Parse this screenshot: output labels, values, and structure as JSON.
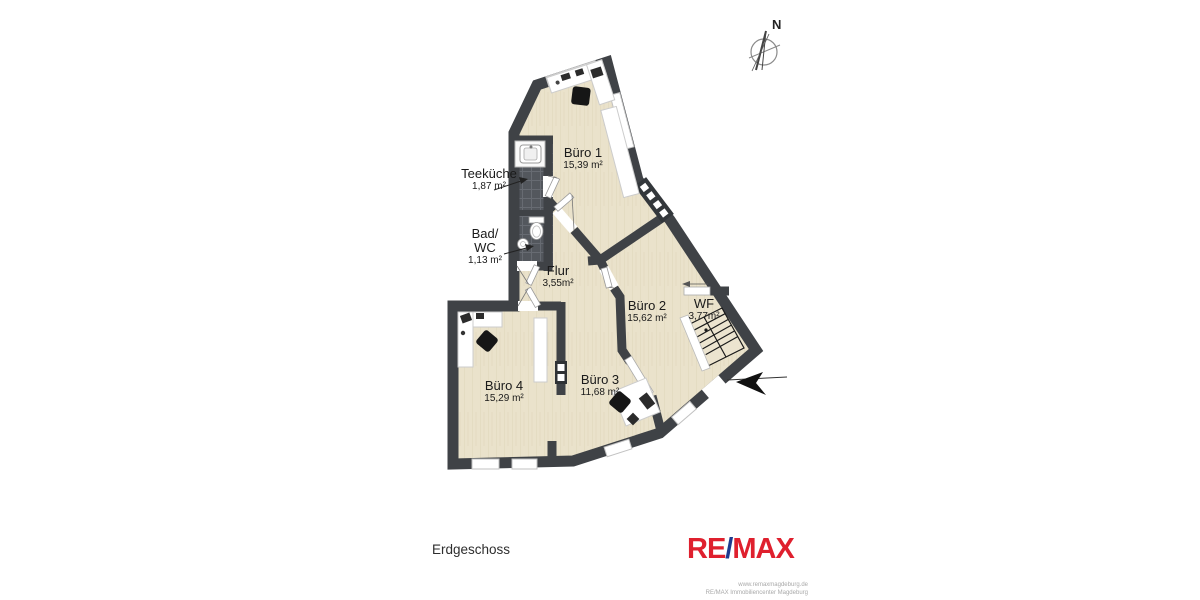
{
  "plan": {
    "floor_label": "Erdgeschoss",
    "compass_label": "N",
    "rooms": {
      "buero1": {
        "name": "Büro 1",
        "area": "15,39 m²"
      },
      "teekueche": {
        "name": "Teeküche",
        "area": "1,87 m²"
      },
      "badwc": {
        "name_line1": "Bad/",
        "name_line2": "WC",
        "area": "1,13 m²"
      },
      "flur": {
        "name": "Flur",
        "area": "3,55m²"
      },
      "buero2": {
        "name": "Büro 2",
        "area": "15,62 m²"
      },
      "wf": {
        "name": "WF",
        "area": "3,77m²"
      },
      "buero3": {
        "name": "Büro 3",
        "area": "11,68 m²"
      },
      "buero4": {
        "name": "Büro 4",
        "area": "15,29 m²"
      }
    }
  },
  "branding": {
    "logo_re": "RE",
    "logo_slash": "/",
    "logo_max": "MAX",
    "website": "www.remaxmagdeburg.de",
    "company": "RE/MAX Immobiliencenter Magdeburg",
    "logo_red": "#df202e",
    "logo_blue": "#1d3a8f"
  },
  "colors": {
    "wall": "#3f4246",
    "floor": "#eae2cb",
    "tile": "#53575d"
  }
}
